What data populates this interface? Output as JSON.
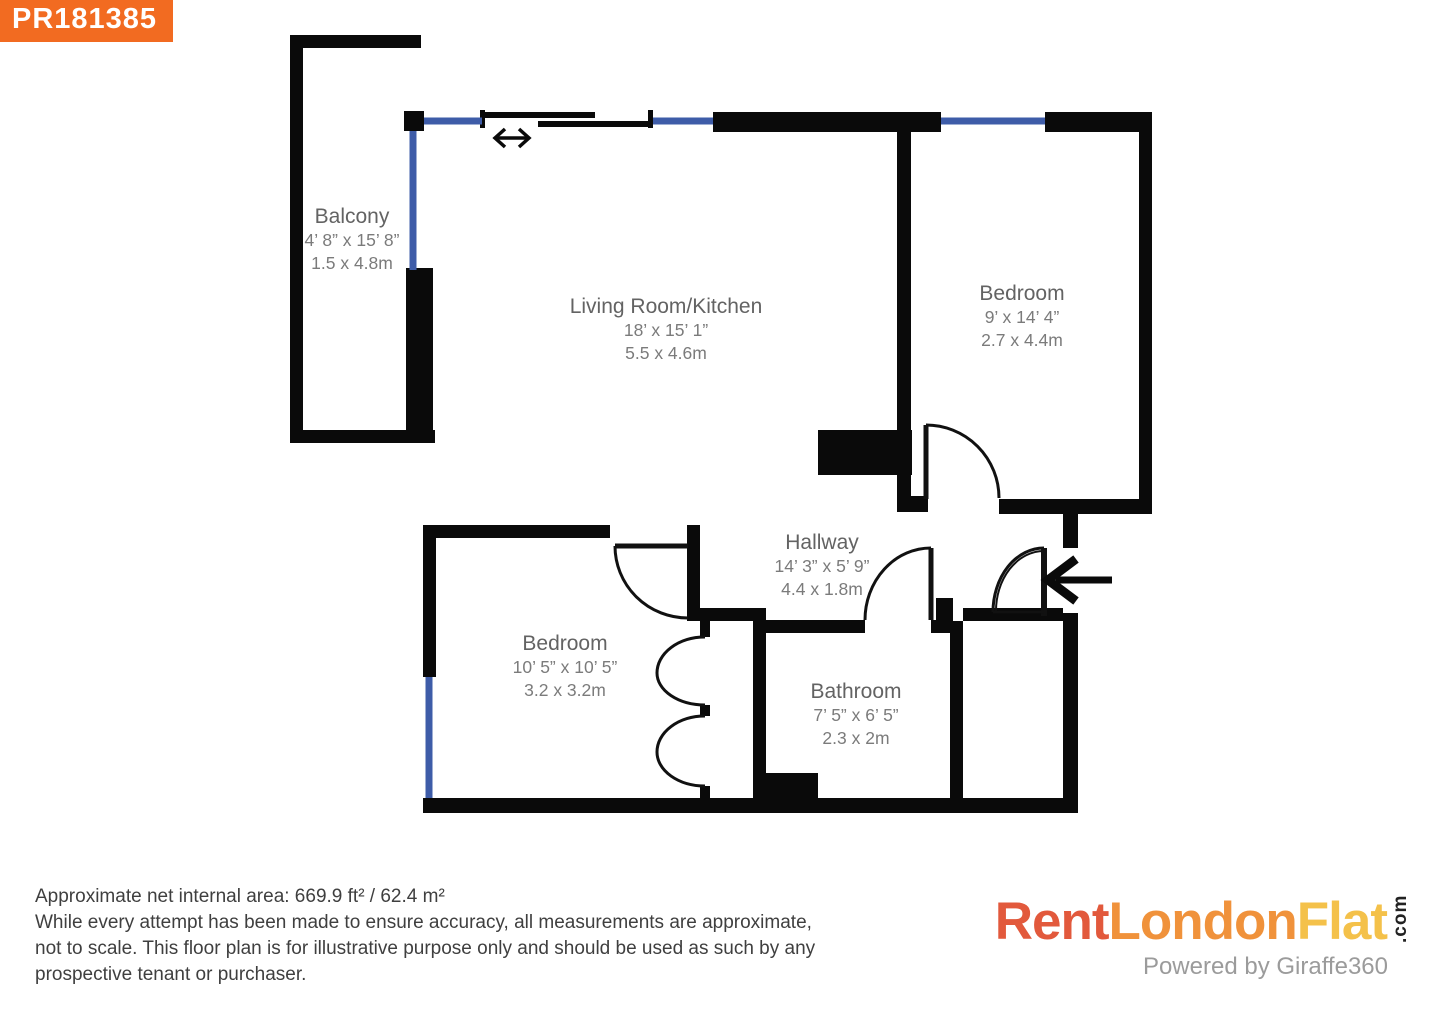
{
  "badge": {
    "reference": "PR181385"
  },
  "rooms": {
    "balcony": {
      "name": "Balcony",
      "imperial": "4’ 8” x 15’ 8”",
      "metric": "1.5 x 4.8m"
    },
    "living": {
      "name": "Living Room/Kitchen",
      "imperial": "18’ x 15’ 1”",
      "metric": "5.5 x 4.6m"
    },
    "bedroom1": {
      "name": "Bedroom",
      "imperial": "9’ x 14’ 4”",
      "metric": "2.7 x 4.4m"
    },
    "hallway": {
      "name": "Hallway",
      "imperial": "14’ 3” x 5’ 9”",
      "metric": "4.4 x 1.8m"
    },
    "bedroom2": {
      "name": "Bedroom",
      "imperial": "10’ 5” x 10’ 5”",
      "metric": "3.2 x 3.2m"
    },
    "bathroom": {
      "name": "Bathroom",
      "imperial": "7’ 5” x 6’ 5”",
      "metric": "2.3 x 2m"
    }
  },
  "footer": {
    "line1": "Approximate net internal area: 669.9 ft² / 62.4 m²",
    "line2": "While every attempt has been made to ensure accuracy, all measurements are approximate,",
    "line3": "not to scale. This floor plan is for illustrative purpose only and should be used as such by any",
    "line4": "prospective tenant or purchaser."
  },
  "logo": {
    "part1": "Rent",
    "part2": "London",
    "part3": "Flat",
    "tld": ".com",
    "powered_by": "Powered by Giraffe360"
  },
  "colors": {
    "wall": "#0a0a0a",
    "window": "#3e5ca8",
    "badge_background": "#f26b21",
    "logo_part1": "#e2593c",
    "logo_part2": "#f0923b",
    "logo_part3": "#f4c14a"
  }
}
